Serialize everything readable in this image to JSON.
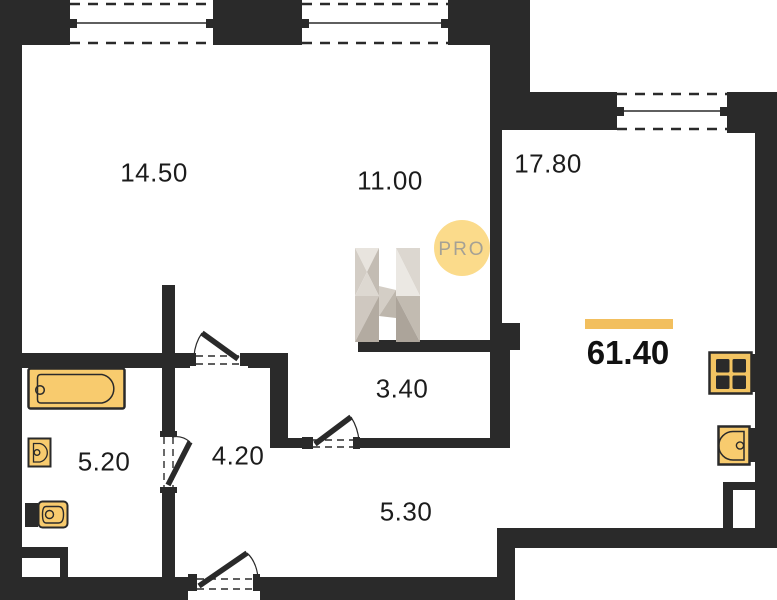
{
  "title": "apartment-floor-plan",
  "colors": {
    "wall": "#2A2A2A",
    "accent": "#F2BF5E",
    "fix": "#F8CB6E",
    "stove": "#F3C462",
    "logoCircle": "#FBDB8B",
    "logoText": "#A5A195",
    "text": "#1C1C1C"
  },
  "rooms": [
    {
      "name": "room-14-50",
      "area": "14.50"
    },
    {
      "name": "room-11-00",
      "area": "11.00"
    },
    {
      "name": "room-17-80",
      "area": "17.80"
    },
    {
      "name": "room-3-40",
      "area": "3.40"
    },
    {
      "name": "room-4-20",
      "area": "4.20"
    },
    {
      "name": "room-5-20",
      "area": "5.20"
    },
    {
      "name": "room-5-30",
      "area": "5.30"
    }
  ],
  "total_area": "61.40",
  "watermark": {
    "brand_letter": "H",
    "badge": "PRO"
  },
  "fixtures": [
    "bathtub-icon",
    "washbasin-icon",
    "toilet-icon",
    "stove-icon",
    "kitchen-sink-icon"
  ],
  "features": [
    "window",
    "door-swing",
    "wall-niche"
  ]
}
